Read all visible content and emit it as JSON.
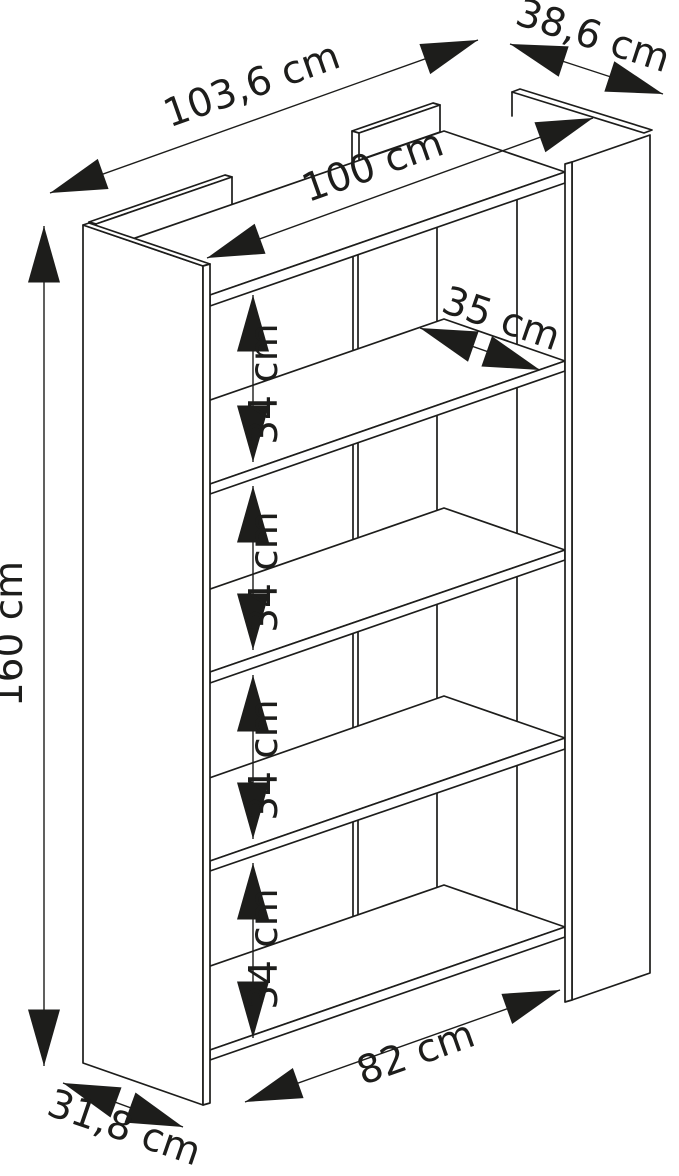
{
  "diagram": {
    "kind": "furniture-dimension-drawing",
    "subject": "bookcase with five shelves, two side panels and back dividers",
    "unit": "cm",
    "colors": {
      "line": "#1d1d1b",
      "background": "#ffffff"
    }
  },
  "dims": {
    "total_width": {
      "label": "103,6 cm",
      "value": 103.6
    },
    "top_depth": {
      "label": "38,6 cm",
      "value": 38.6
    },
    "inner_width": {
      "label": "100 cm",
      "value": 100
    },
    "shelf_depth": {
      "label": "35 cm",
      "value": 35
    },
    "height": {
      "label": "160 cm",
      "value": 160
    },
    "shelf_gap_1": {
      "label": "34 cm",
      "value": 34
    },
    "shelf_gap_2": {
      "label": "34 cm",
      "value": 34
    },
    "shelf_gap_3": {
      "label": "34 cm",
      "value": 34
    },
    "shelf_gap_4": {
      "label": "34 cm",
      "value": 34
    },
    "bottom_inner_width": {
      "label": "82 cm",
      "value": 82
    },
    "bottom_depth": {
      "label": "31,8 cm",
      "value": 31.8
    }
  },
  "structure": {
    "shelf_count": 5,
    "shelf_gap_count": 4,
    "side_panel_count": 2
  }
}
